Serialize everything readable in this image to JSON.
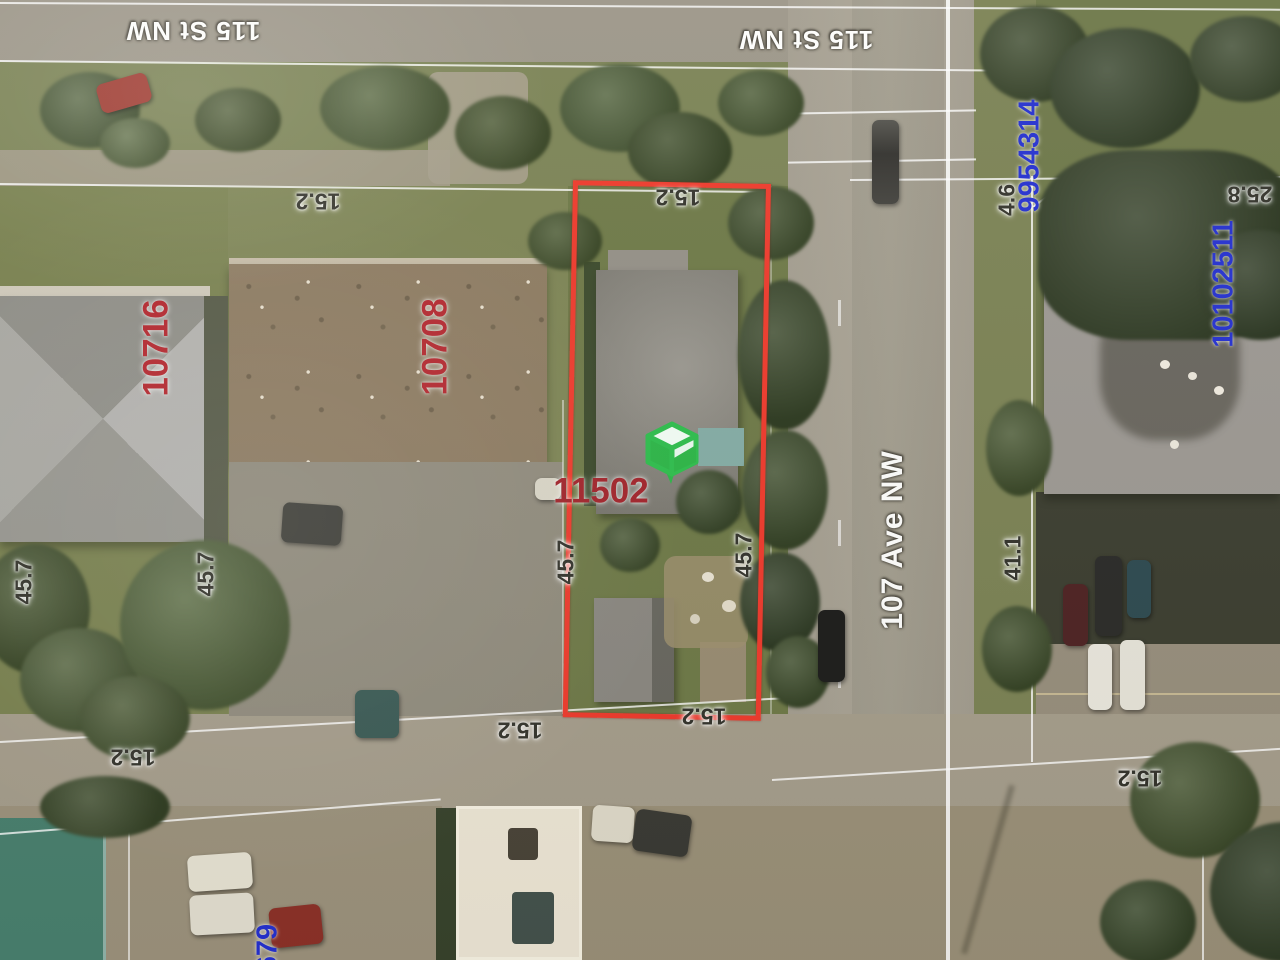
{
  "map": {
    "title": "Aerial parcel map photograph",
    "streets": {
      "street_top": "115 St NW",
      "avenue_right": "107 Ave NW"
    },
    "addresses": {
      "house_left": "10716",
      "house_mid": "10708",
      "subject": "11502"
    },
    "parcel_ids": {
      "upper_right": "9954314",
      "lower_right": "10102511",
      "bottom_partial": "679"
    },
    "dims": {
      "lot_width": "15.2",
      "lot_depth": "45.7",
      "boulevard": "4.6",
      "right_width": "25.8",
      "right_depth": "41.1"
    },
    "marker": {
      "name": "subject-property-cube-marker"
    },
    "colors": {
      "outline_red": "#ee3a2c",
      "address_red": "#b3272e",
      "parcel_blue": "#2531cf",
      "marker_green": "#2fbe4d",
      "street_white": "#fdfdfb",
      "dim_dark": "#34342c"
    }
  }
}
